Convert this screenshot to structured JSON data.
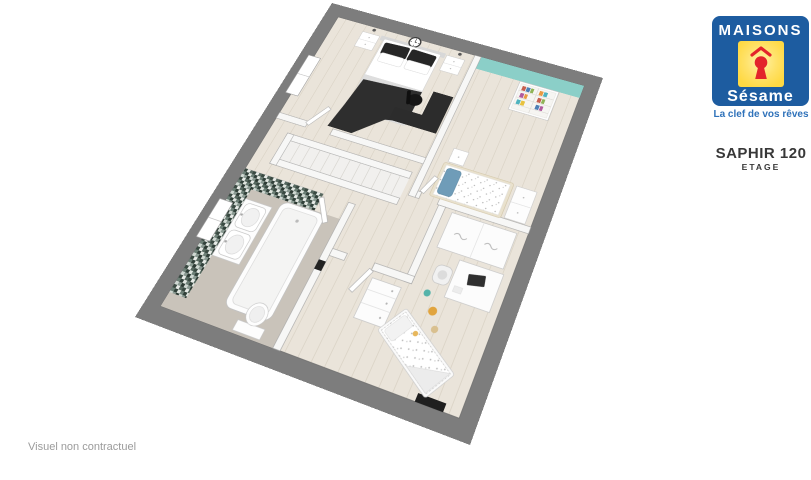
{
  "branding": {
    "brand_top": "MAISONS",
    "brand_script": "Sésame",
    "tagline": "La clef de vos rêves",
    "colors": {
      "blue": "#1d5ca0",
      "yellow": "#ffd943",
      "red": "#e3242b"
    }
  },
  "plan_info": {
    "model_name": "SAPHIR 120",
    "level_label": "ETAGE"
  },
  "footer": {
    "disclaimer": "Visuel non contractuel"
  },
  "floorplan": {
    "colors": {
      "exterior_wall": "#7d7d7d",
      "interior_wall": "#f7f7f6",
      "wood_floor": "#eae4da",
      "bathroom_floor": "#c9c3ba",
      "accent_wall_teal": "#8bcfc8",
      "mosaic_tile": "#43524c",
      "dark_furniture": "#2c2c2c",
      "kid_pillow_blue": "#6f9cb8"
    }
  }
}
